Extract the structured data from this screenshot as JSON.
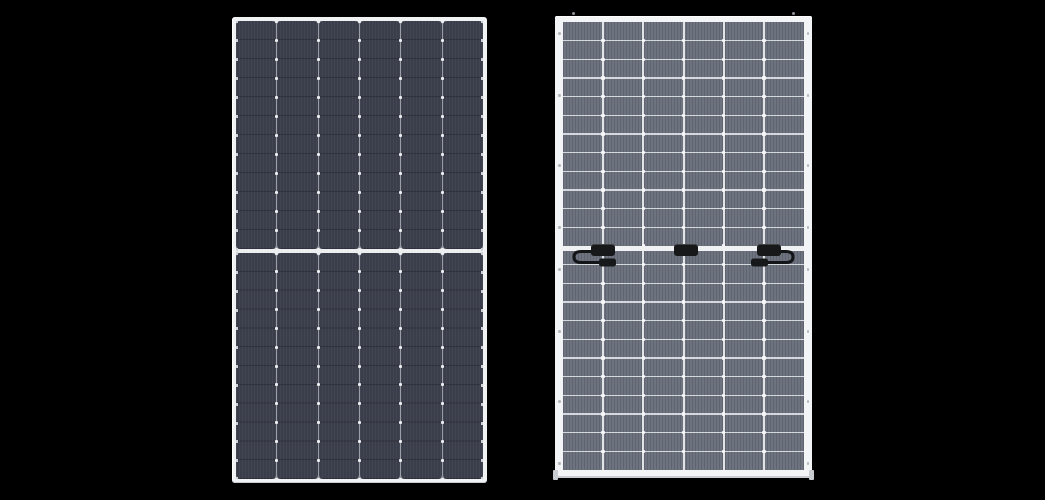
{
  "scene": {
    "background_color": "#000000",
    "description": "Product render of a bifacial solar module shown from the front (left) and the back (right) on a black background"
  },
  "front_panel": {
    "id": "module-front-view",
    "geometry": {
      "x": 232,
      "y": 17,
      "width": 255,
      "height": 466,
      "frame_thickness": 4,
      "mid_divider_rel_y": 228,
      "mid_divider_height": 4
    },
    "grid": {
      "columns": 6,
      "rows_per_half": 12,
      "column_gap": 1
    },
    "colors": {
      "frame": "#f1f2f4",
      "frame_shade": "#c7cace",
      "gap_bg": "#9a9da6",
      "cell": "#3a3e4a",
      "row_line": "rgba(0,0,0,0.22)",
      "busbar_texture": "rgba(255,255,255,0.045)",
      "solder_dot": "#eceef1",
      "edge_tick": "#ced1d6",
      "mid_divider": "#eceef0"
    }
  },
  "back_panel": {
    "id": "module-back-view",
    "geometry": {
      "x": 555,
      "y": 16,
      "width": 257,
      "height": 462,
      "frame_side": 8,
      "frame_top": 6,
      "frame_bottom": 8,
      "mid_band_rel_y": 224,
      "mid_band_height": 5
    },
    "grid": {
      "columns": 6,
      "rows": 24
    },
    "colors": {
      "frame": "#f3f4f6",
      "frame_shade": "#c9ccd1",
      "cell": "#6e7380",
      "cell_stripe": "rgba(0,0,0,0.13)",
      "grid_line": "#e8eaed",
      "intersection_dot": "#f6f7f9",
      "mid_band": "#f0f1f3",
      "junction_box": "#17181a",
      "cable": "#141518",
      "screw_dot": "#b4b7bd",
      "corner_foot": "#c8cbd0"
    },
    "junction_boxes": {
      "count": 3,
      "rel_centers_x": [
        40,
        123,
        206
      ],
      "rel_y": 222,
      "width": 24,
      "height": 12
    },
    "cables": {
      "left_loop": true,
      "right_loop": true,
      "connector_width": 17,
      "connector_height": 8
    }
  }
}
